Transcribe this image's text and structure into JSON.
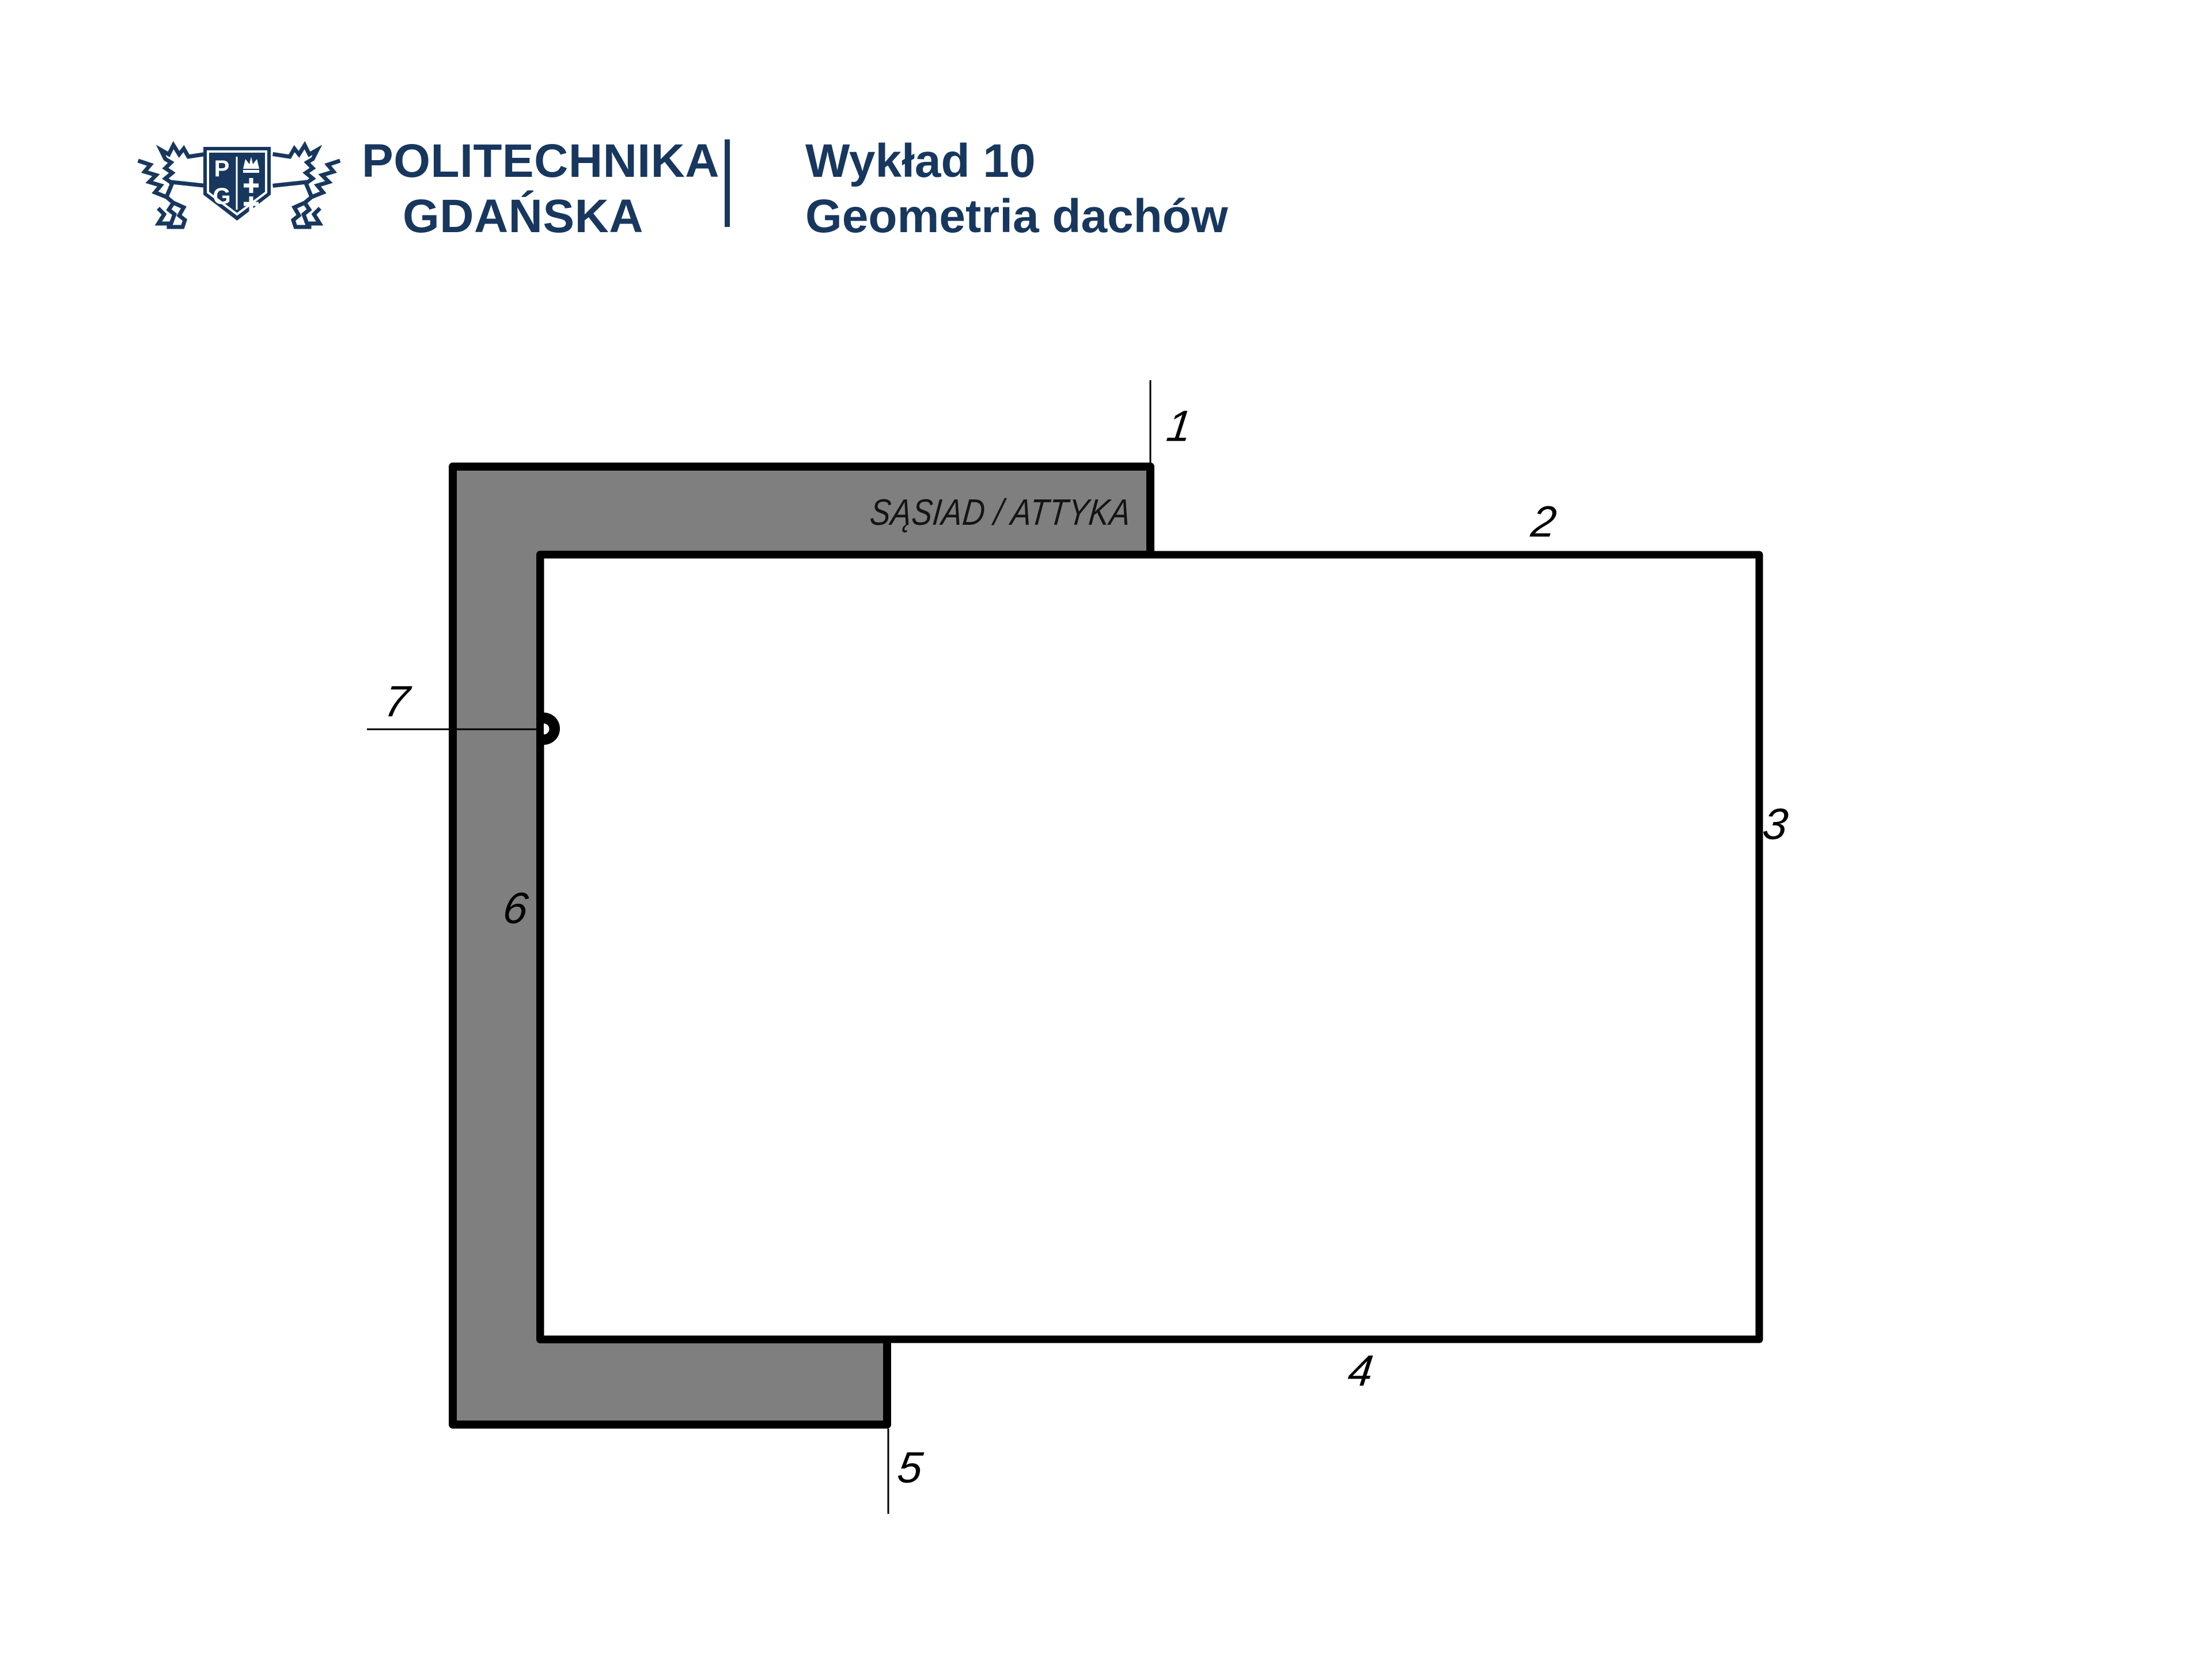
{
  "header": {
    "logo": {
      "name": "politechnika-gdanska-crest",
      "monogram_left": "P",
      "monogram_right": "G"
    },
    "university_name_line1": "POLITECHNIKA",
    "university_name_line2": "GDAŃSKA",
    "lecture_title": "Wykład 10",
    "lecture_subtitle": "Geometria dachów"
  },
  "diagram": {
    "region_label": "SĄSIAD / ATTYKA",
    "edge_labels": [
      "1",
      "2",
      "3",
      "4",
      "5",
      "6",
      "7"
    ],
    "colors": {
      "navy": "#17375e",
      "gray_fill": "#7f7f7f",
      "outline": "#000000",
      "white_fill": "#ffffff"
    }
  }
}
